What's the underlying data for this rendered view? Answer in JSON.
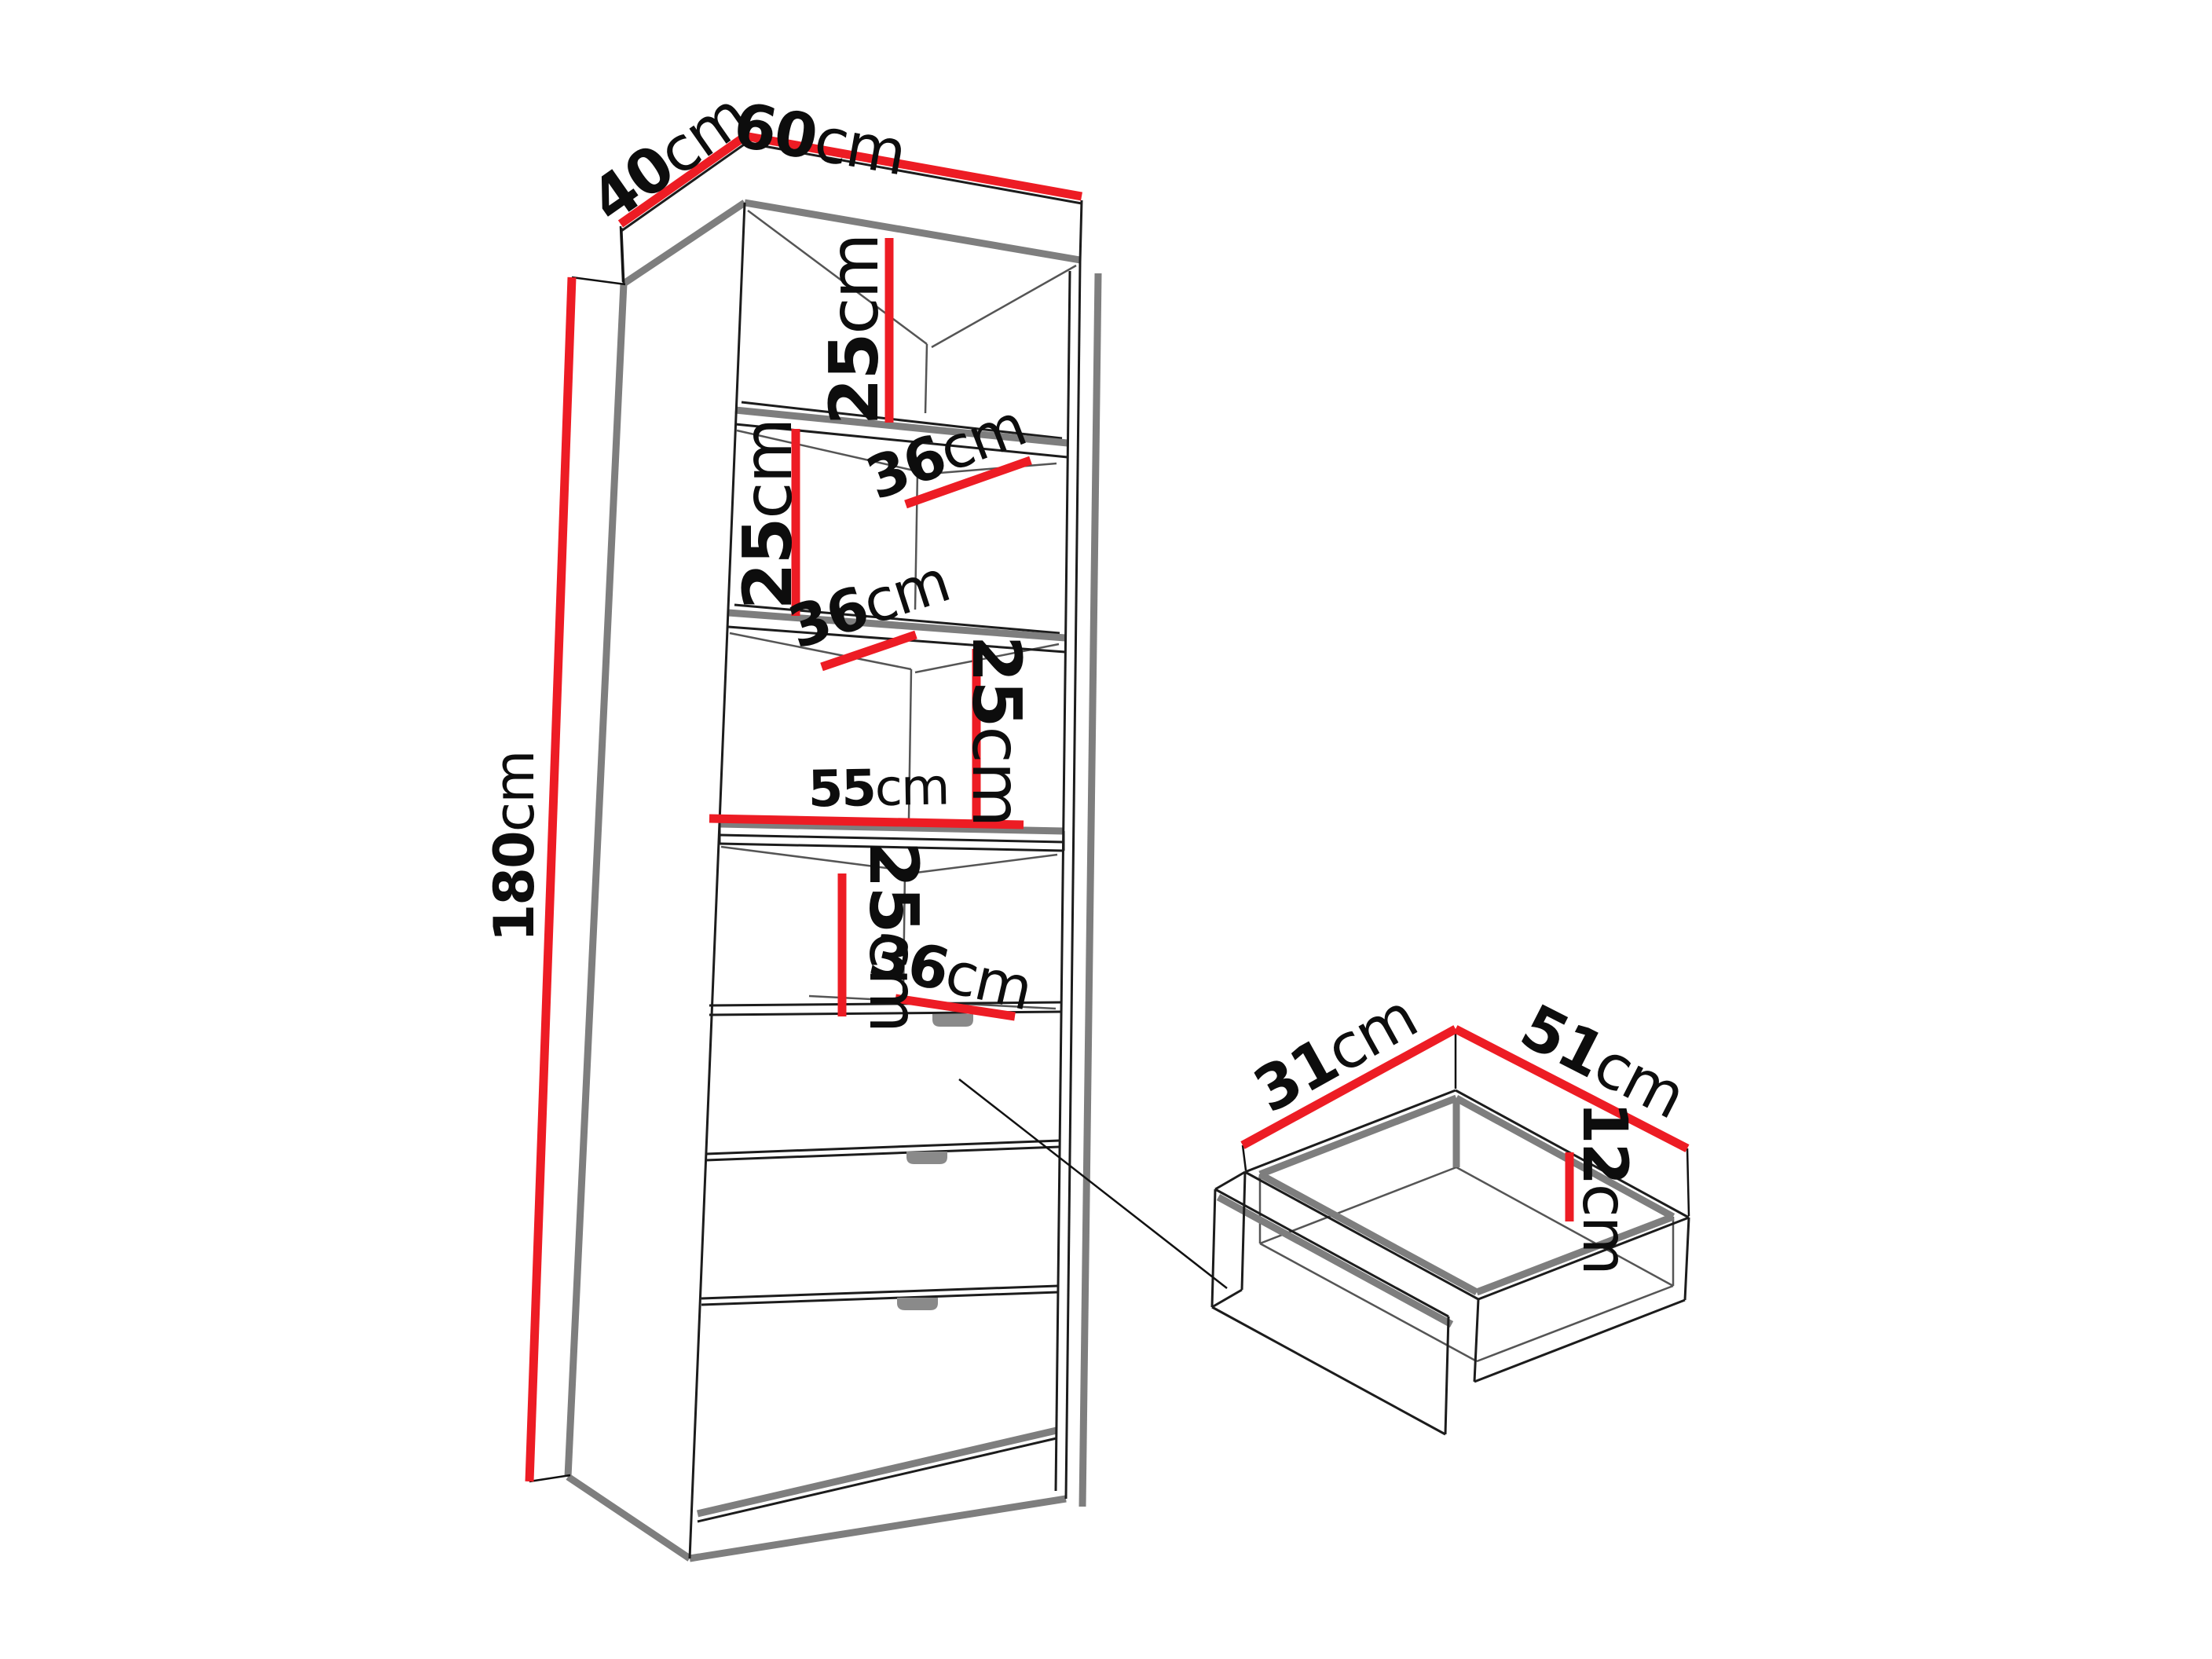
{
  "colors": {
    "dimension_red": "#ED1C24",
    "edge_gray": "#7E7E7E",
    "line_black": "#1C1C1C",
    "handle_gray": "#8A8A8A"
  },
  "cabinet": {
    "description": "tall cabinet with 4 open compartments, 3 shelves and 3 drawers, perspective line drawing",
    "dims": {
      "depth_top": {
        "num": "40",
        "unit": "cm"
      },
      "width_top": {
        "num": "60",
        "unit": "cm"
      },
      "height": {
        "num": "180",
        "unit": "cm"
      },
      "compartment1_height": {
        "num": "25",
        "unit": "cm"
      },
      "shelf1_depth": {
        "num": "36",
        "unit": "cm"
      },
      "compartment2_height": {
        "num": "25",
        "unit": "cm"
      },
      "shelf2_depth": {
        "num": "36",
        "unit": "cm"
      },
      "compartment3_height": {
        "num": "25",
        "unit": "cm"
      },
      "interior_width": {
        "num": "55",
        "unit": "cm"
      },
      "compartment4_height": {
        "num": "25",
        "unit": "cm"
      },
      "shelf3_depth": {
        "num": "36",
        "unit": "cm"
      }
    }
  },
  "drawer": {
    "description": "detail view of pulled-out drawer box, open top",
    "dims": {
      "depth": {
        "num": "31",
        "unit": "cm"
      },
      "width": {
        "num": "51",
        "unit": "cm"
      },
      "inner_height": {
        "num": "12",
        "unit": "cm"
      }
    }
  }
}
